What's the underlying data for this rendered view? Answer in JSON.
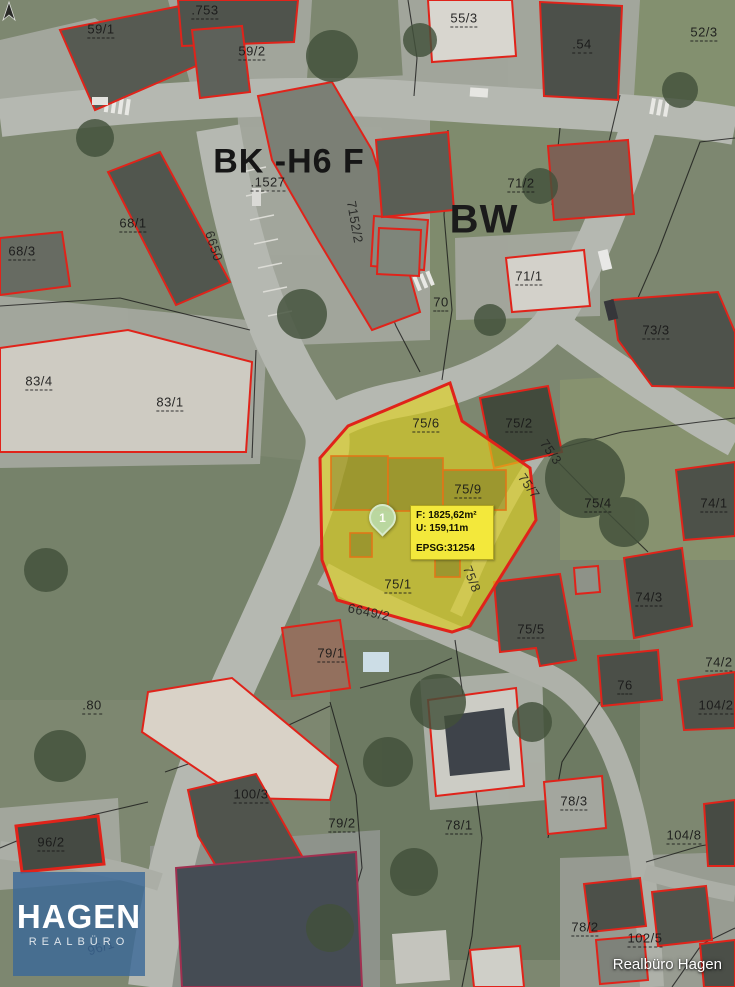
{
  "map": {
    "credit": "Realbüro Hagen",
    "logo": {
      "title": "HAGEN",
      "subtitle": "REALBÜRO"
    },
    "marker": {
      "label": "1"
    },
    "info_box": {
      "area_label": "F: 1825,62m²",
      "perimeter_label": "U: 159,11m",
      "epsg_label": "EPSG:31254"
    },
    "colors": {
      "parcel_outline": "#e0231a",
      "highlight_fill": "#e3d51c",
      "info_bg": "#f3e83b",
      "logo_bg": "#3a6898",
      "marker_fill": "#bad9a7"
    },
    "zone_note": "Cadastral aerial map with highlighted parcel",
    "labels": [
      {
        "t": ".753",
        "x": 205,
        "y": 11,
        "v": "p"
      },
      {
        "t": "59/1",
        "x": 101,
        "y": 30,
        "v": "p"
      },
      {
        "t": "59/2",
        "x": 252,
        "y": 52,
        "v": "p"
      },
      {
        "t": "55/3",
        "x": 464,
        "y": 19,
        "v": "p"
      },
      {
        "t": ".54",
        "x": 582,
        "y": 45,
        "v": "p"
      },
      {
        "t": "52/3",
        "x": 704,
        "y": 33,
        "v": "p"
      },
      {
        "t": "BK -H6 F",
        "x": 289,
        "y": 162,
        "v": "z"
      },
      {
        "t": ".1527",
        "x": 268,
        "y": 183,
        "v": "p"
      },
      {
        "t": "71/2",
        "x": 521,
        "y": 184,
        "v": "p"
      },
      {
        "t": "BW",
        "x": 484,
        "y": 220,
        "v": "z2"
      },
      {
        "t": "7152/2",
        "x": 355,
        "y": 222,
        "rot": 80,
        "v": "r"
      },
      {
        "t": "6650",
        "x": 214,
        "y": 246,
        "rot": 72,
        "v": "r"
      },
      {
        "t": "68/1",
        "x": 133,
        "y": 224,
        "v": "p"
      },
      {
        "t": "68/3",
        "x": 22,
        "y": 252,
        "v": "p"
      },
      {
        "t": "70",
        "x": 441,
        "y": 303,
        "v": "p"
      },
      {
        "t": "71/1",
        "x": 529,
        "y": 277,
        "v": "p"
      },
      {
        "t": "73/3",
        "x": 656,
        "y": 331,
        "v": "p"
      },
      {
        "t": "83/4",
        "x": 39,
        "y": 382,
        "v": "p"
      },
      {
        "t": "83/1",
        "x": 170,
        "y": 403,
        "v": "p"
      },
      {
        "t": "75/6",
        "x": 426,
        "y": 424,
        "v": "p"
      },
      {
        "t": "75/2",
        "x": 519,
        "y": 424,
        "v": "p"
      },
      {
        "t": "75/3",
        "x": 551,
        "y": 452,
        "rot": 55,
        "v": "r"
      },
      {
        "t": "75/7",
        "x": 529,
        "y": 486,
        "rot": 55,
        "v": "r"
      },
      {
        "t": "75/9",
        "x": 468,
        "y": 490,
        "v": "p"
      },
      {
        "t": "75/4",
        "x": 598,
        "y": 504,
        "v": "p"
      },
      {
        "t": "74/1",
        "x": 714,
        "y": 504,
        "v": "p"
      },
      {
        "t": "75/1",
        "x": 398,
        "y": 585,
        "v": "p"
      },
      {
        "t": "75/8",
        "x": 472,
        "y": 579,
        "rot": 68,
        "v": "r"
      },
      {
        "t": "6649/2",
        "x": 369,
        "y": 612,
        "rot": 12,
        "v": "r"
      },
      {
        "t": "75/5",
        "x": 531,
        "y": 630,
        "v": "p"
      },
      {
        "t": "74/3",
        "x": 649,
        "y": 598,
        "v": "p"
      },
      {
        "t": "74/2",
        "x": 719,
        "y": 663,
        "v": "p"
      },
      {
        "t": "76",
        "x": 625,
        "y": 686,
        "v": "p"
      },
      {
        "t": "104/2",
        "x": 716,
        "y": 706,
        "v": "p"
      },
      {
        "t": ".80",
        "x": 92,
        "y": 706,
        "v": "p"
      },
      {
        "t": "79/1",
        "x": 331,
        "y": 654,
        "v": "p"
      },
      {
        "t": "100/3",
        "x": 251,
        "y": 795,
        "v": "p"
      },
      {
        "t": "79/2",
        "x": 342,
        "y": 824,
        "v": "p"
      },
      {
        "t": "78/1",
        "x": 459,
        "y": 826,
        "v": "p"
      },
      {
        "t": "78/3",
        "x": 574,
        "y": 802,
        "v": "p"
      },
      {
        "t": "104/8",
        "x": 684,
        "y": 836,
        "v": "p"
      },
      {
        "t": "96/2",
        "x": 51,
        "y": 843,
        "v": "p"
      },
      {
        "t": "78/2",
        "x": 585,
        "y": 928,
        "v": "p"
      },
      {
        "t": "102/5",
        "x": 645,
        "y": 939,
        "v": "p"
      },
      {
        "t": "96/1",
        "x": 101,
        "y": 947,
        "rot": -18,
        "v": "r"
      }
    ]
  }
}
